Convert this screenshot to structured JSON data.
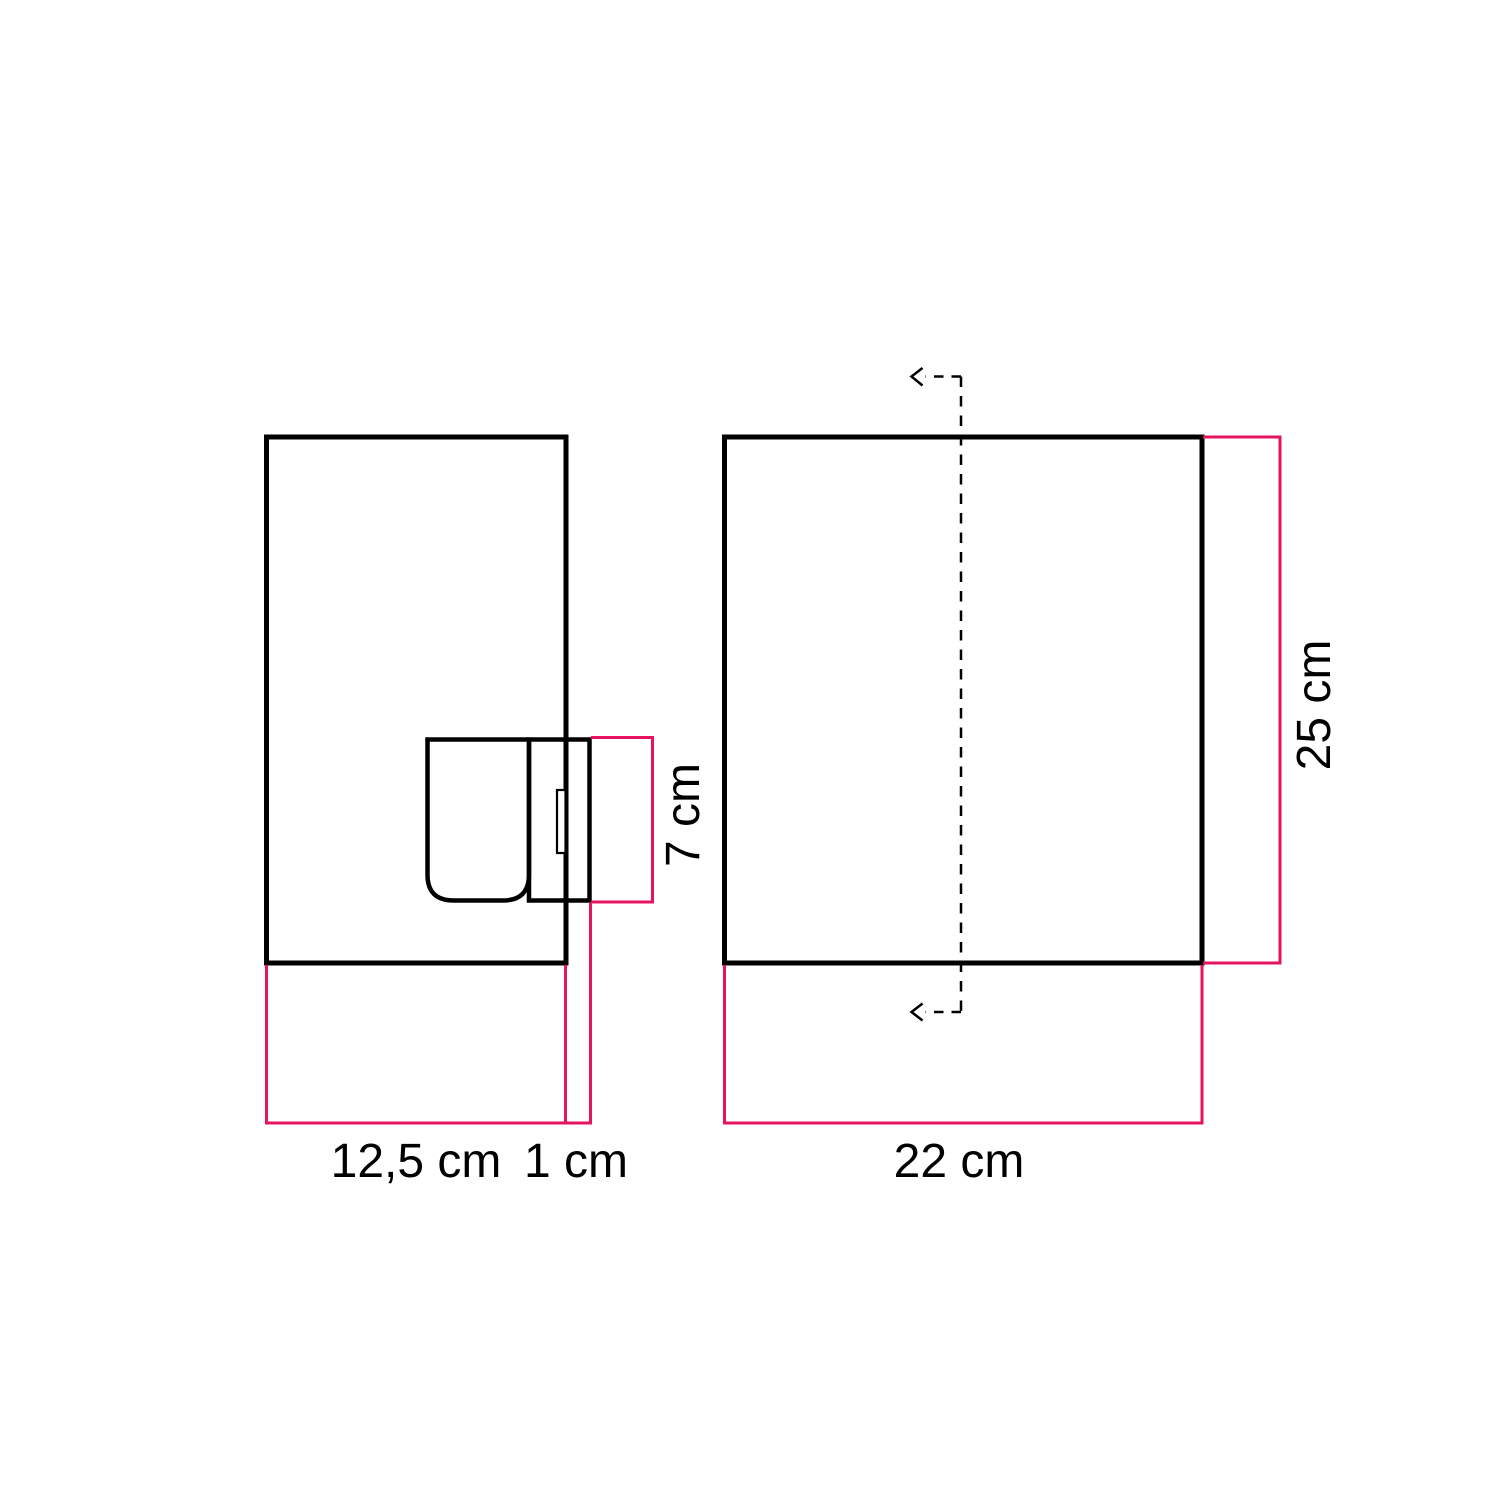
{
  "colors": {
    "accent": "#e6135f",
    "ink": "#000000",
    "background": "#ffffff"
  },
  "diagram": {
    "side_view": {
      "width_label": "12,5 cm",
      "wall_offset_label": "1 cm",
      "holder_height_label": "7 cm"
    },
    "front_view": {
      "width_label": "22 cm",
      "height_label": "25 cm"
    }
  }
}
